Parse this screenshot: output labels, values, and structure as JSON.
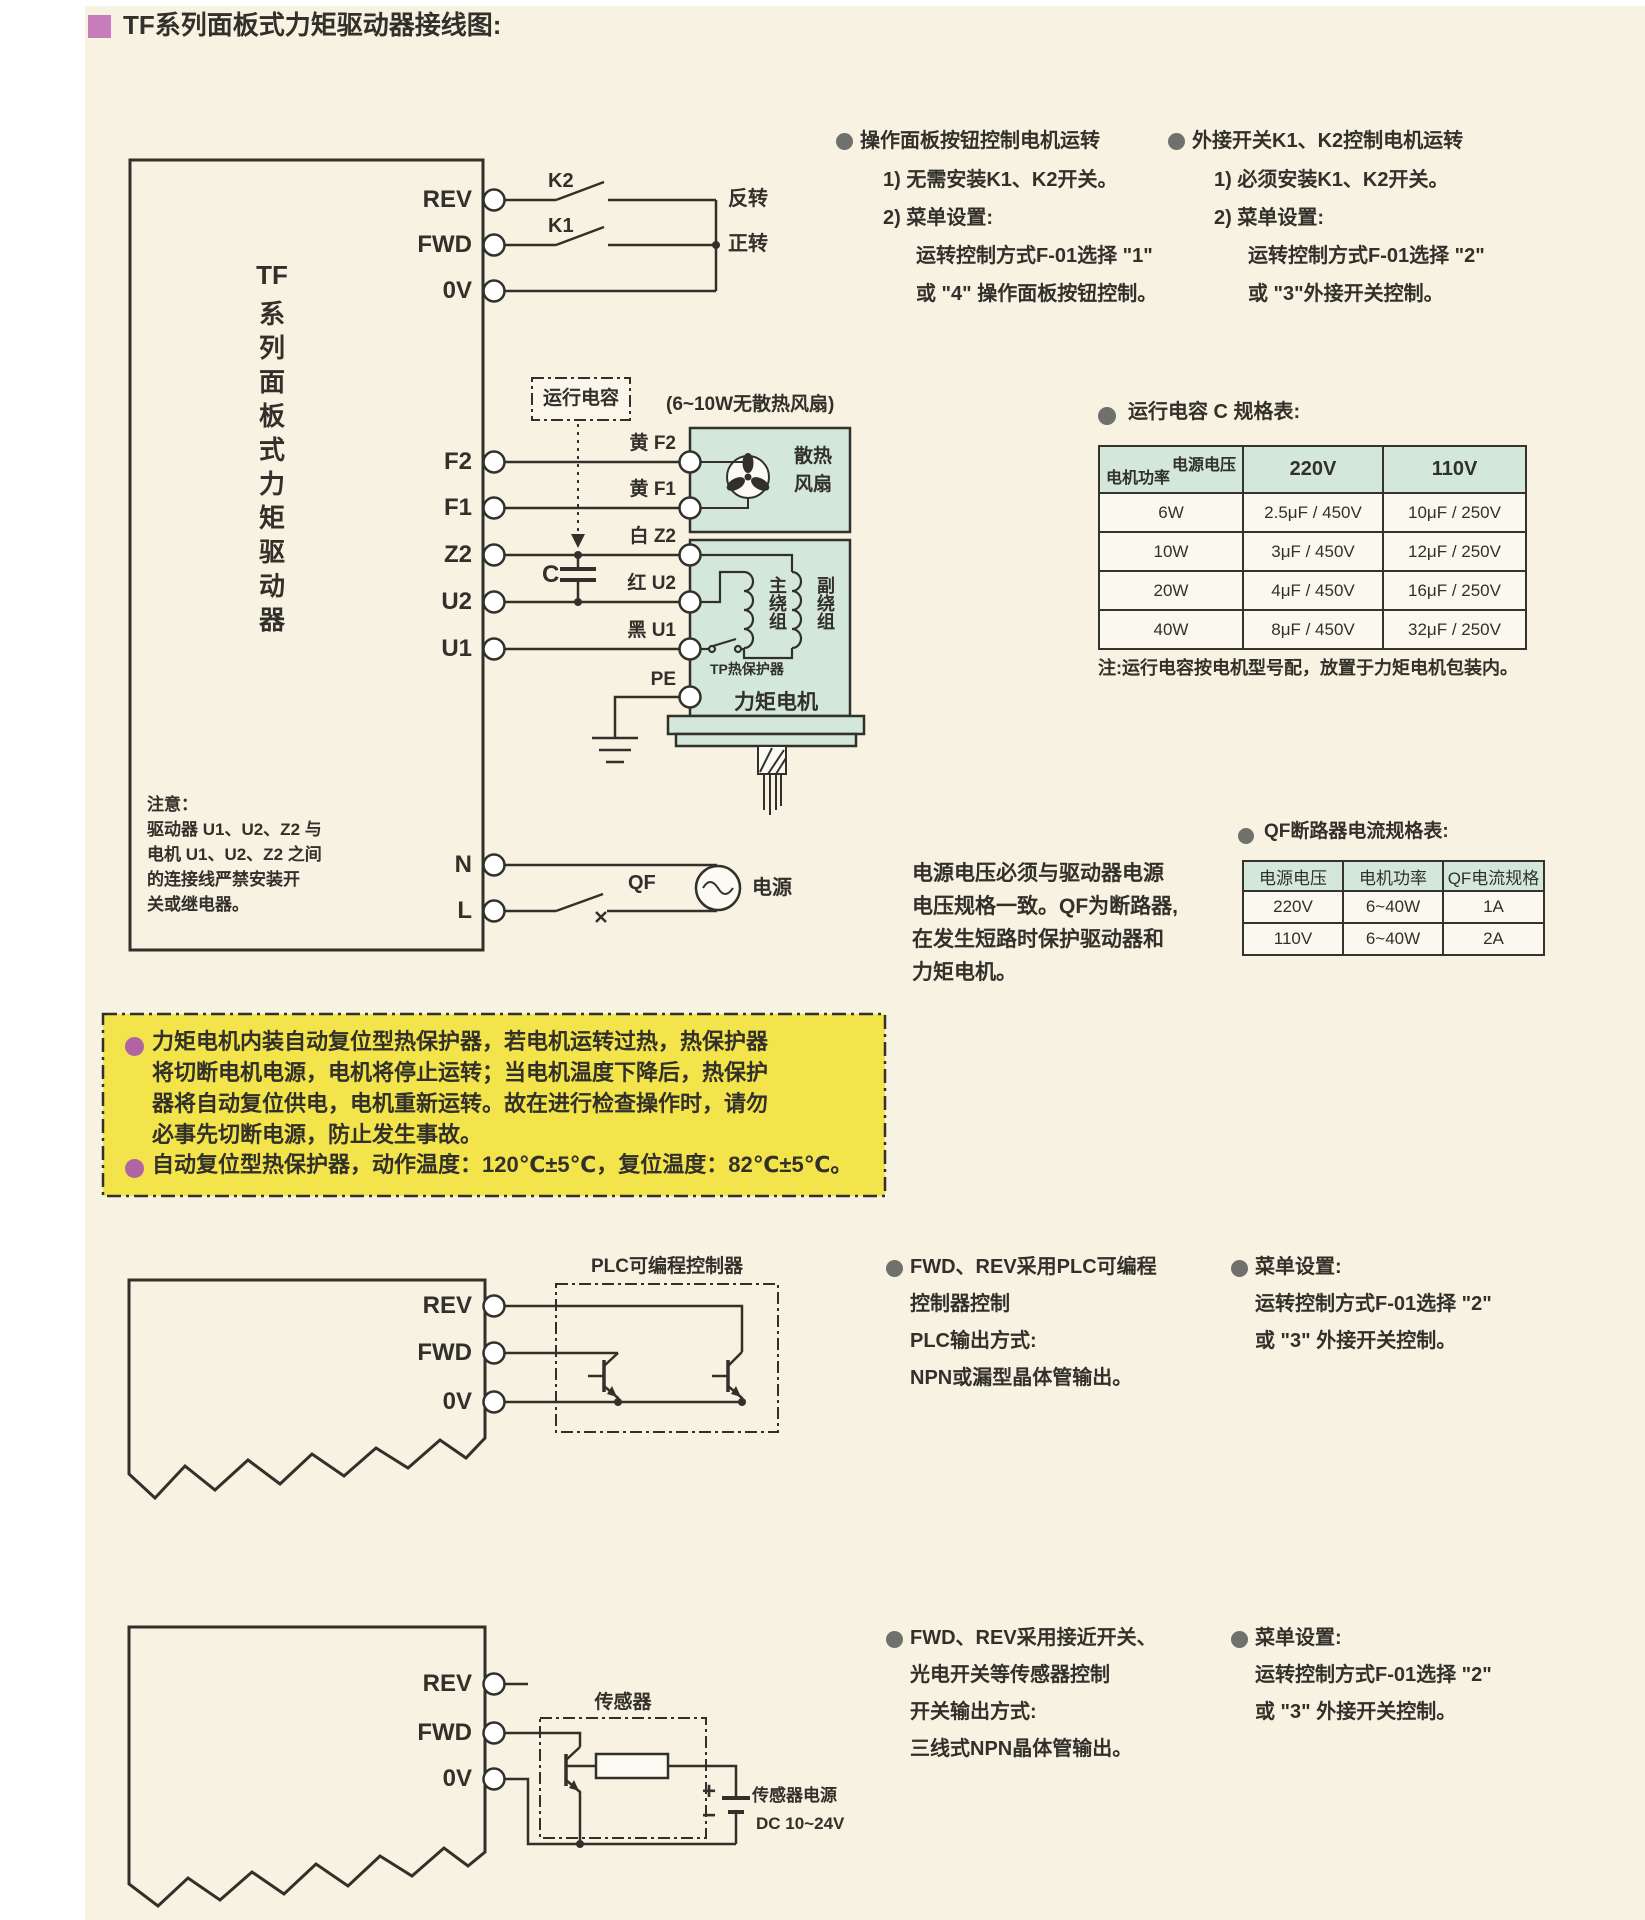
{
  "title": "TF系列面板式力矩驱动器接线图:",
  "colors": {
    "accent_pink": "#c77cbc",
    "bullet_gray": "#70706c",
    "bullet_purple": "#b164a4",
    "warning_yellow": "#f2e44a",
    "table_teal": "#d3e8da",
    "ink": "#32302a",
    "background_cream": "#f7f2e1"
  },
  "driver1": {
    "name_parts": [
      "TF",
      "系",
      "列",
      "面",
      "板",
      "式",
      "力",
      "矩",
      "驱",
      "动",
      "器"
    ],
    "terminals": {
      "rev": "REV",
      "fwd": "FWD",
      "ov": "0V",
      "f2": "F2",
      "f1": "F1",
      "z2": "Z2",
      "u2": "U2",
      "u1": "U1",
      "n": "N",
      "l": "L"
    },
    "note_lines": [
      "注意：",
      "驱动器 U1、U2、Z2 与",
      "电机 U1、U2、Z2 之间",
      "的连接线严禁安装开",
      "关或继电器。"
    ]
  },
  "diagram1": {
    "k2": "K2",
    "k1": "K1",
    "reverse": "反转",
    "forward": "正转",
    "run_cap": "运行电容",
    "cap_c": "C",
    "fan_note": "(6~10W无散热风扇)",
    "wire_f2": "黄 F2",
    "wire_f1": "黄 F1",
    "wire_z2": "白 Z2",
    "wire_u2": "红 U2",
    "wire_u1": "黑 U1",
    "pe": "PE",
    "fan_line1": "散热",
    "fan_line2": "风扇",
    "main_winding": "主绕组",
    "aux_winding": "副绕组",
    "tp": "TP热保护器",
    "motor": "力矩电机",
    "qf": "QF",
    "power": "电源"
  },
  "note_left": {
    "heading": "操作面板按钮控制电机运转",
    "item1": "1) 无需安装K1、K2开关。",
    "item2": "2) 菜单设置:",
    "sub1": "运转控制方式F-01选择 \"1\"",
    "sub2": "或 \"4\" 操作面板按钮控制。"
  },
  "note_right": {
    "heading": "外接开关K1、K2控制电机运转",
    "item1": "1) 必须安装K1、K2开关。",
    "item2": "2) 菜单设置:",
    "sub1": "运转控制方式F-01选择 \"2\"",
    "sub2": "或 \"3\"外接开关控制。"
  },
  "cap_table": {
    "title": "运行电容 C 规格表:",
    "corner_top": "电源电压",
    "corner_bottom": "电机功率",
    "col1": "220V",
    "col2": "110V",
    "rows": [
      [
        "6W",
        "2.5μF / 450V",
        "10μF / 250V"
      ],
      [
        "10W",
        "3μF / 450V",
        "12μF / 250V"
      ],
      [
        "20W",
        "4μF / 450V",
        "16μF / 250V"
      ],
      [
        "40W",
        "8μF / 450V",
        "32μF / 250V"
      ]
    ],
    "note": "注:运行电容按电机型号配，放置于力矩电机包装内。"
  },
  "qf_table": {
    "title": "QF断路器电流规格表:",
    "headers": [
      "电源电压",
      "电机功率",
      "QF电流规格"
    ],
    "rows": [
      [
        "220V",
        "6~40W",
        "1A"
      ],
      [
        "110V",
        "6~40W",
        "2A"
      ]
    ]
  },
  "power_note_lines": [
    "电源电压必须与驱动器电源",
    "电压规格一致。QF为断路器,",
    "在发生短路时保护驱动器和",
    "力矩电机。"
  ],
  "warning": {
    "b1_lines": [
      "力矩电机内装自动复位型热保护器，若电机运转过热，热保护器",
      "将切断电机电源，电机将停止运转；当电机温度下降后，热保护",
      "器将自动复位供电，电机重新运转。故在进行检查操作时，请勿",
      "必事先切断电源，防止发生事故。"
    ],
    "b2": "自动复位型热保护器，动作温度：120℃±5℃，复位温度：82℃±5℃。"
  },
  "plc_section": {
    "box_label": "PLC可编程控制器",
    "terminals": {
      "rev": "REV",
      "fwd": "FWD",
      "ov": "0V"
    },
    "left": {
      "heading": "FWD、REV采用PLC可编程",
      "l2": "控制器控制",
      "l3": "PLC输出方式:",
      "l4": "NPN或漏型晶体管输出。"
    },
    "right": {
      "heading": "菜单设置:",
      "l2": "运转控制方式F-01选择 \"2\"",
      "l3": "或 \"3\" 外接开关控制。"
    }
  },
  "sensor_section": {
    "box_label": "传感器",
    "terminals": {
      "rev": "REV",
      "fwd": "FWD",
      "ov": "0V"
    },
    "battery_plus": "+",
    "battery_minus": "−",
    "battery_l1": "传感器电源",
    "battery_l2": "DC 10~24V",
    "left": {
      "heading": "FWD、REV采用接近开关、",
      "l2": "光电开关等传感器控制",
      "l3": "开关输出方式:",
      "l4": "三线式NPN晶体管输出。"
    },
    "right": {
      "heading": "菜单设置:",
      "l2": "运转控制方式F-01选择 \"2\"",
      "l3": "或 \"3\" 外接开关控制。"
    }
  }
}
